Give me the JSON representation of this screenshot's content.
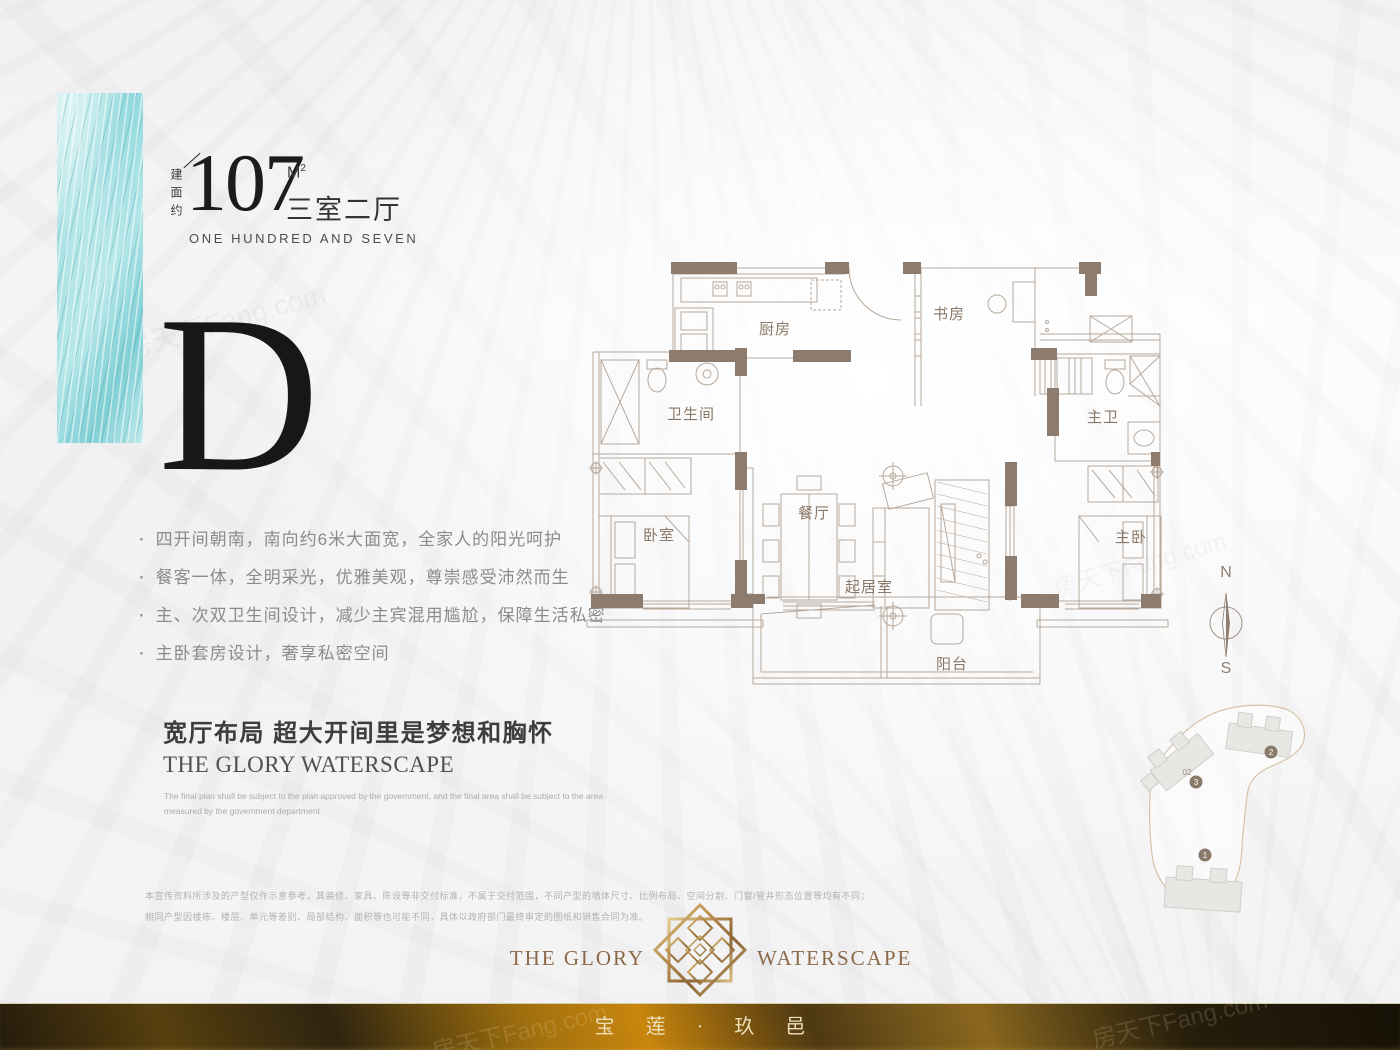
{
  "unit": {
    "area_prefix": "建面约",
    "area_value": "107",
    "area_unit": "M",
    "area_unit_sup": "2",
    "layout_type": "三室二厅",
    "area_words": "ONE HUNDRED AND SEVEN",
    "plan_letter": "D"
  },
  "features": [
    "四开间朝南，南向约6米大面宽，全家人的阳光呵护",
    "餐客一体，全明采光，优雅美观，尊崇感受沛然而生",
    "主、次双卫生间设计，减少主宾混用尴尬，保障生活私密",
    "主卧套房设计，奢享私密空间"
  ],
  "tagline": {
    "title": "宽厅布局 超大开间里是梦想和胸怀",
    "brand_en": "THE GLORY WATERSCAPE",
    "note_line1": "The final plan shall be subject to the plan approved by the government, and the final area shall be subject to the area",
    "note_line2": "measured by the government department"
  },
  "disclaimer": {
    "line1": "本宣传资料所涉及的产型仅作示意参考，其装修、家具、陈设等非交付标准，不属于交付范围，不同产型的墙体尺寸、比例布局、空间分割、门窗/管井形态位置等均有不同；",
    "line2": "相同产型因楼栋、楼层、单元等差别、局部结构、面积等也可能不同，具体以政府部门最终审定的图纸和销售合同为准。"
  },
  "floorplan": {
    "rooms": {
      "kitchen": "厨房",
      "study": "书房",
      "bathroom": "卫生间",
      "master_bathroom": "主卫",
      "bedroom": "卧室",
      "dining": "餐厅",
      "living": "起居室",
      "master_bedroom": "主卧",
      "balcony": "阳台"
    }
  },
  "compass": {
    "north": "N",
    "south": "S"
  },
  "siteplan": {
    "badge1": "1",
    "badge2": "2",
    "badge3": "3",
    "unit_label": "02"
  },
  "brand": {
    "name_left": "THE GLORY",
    "name_right": "WATERSCAPE",
    "name_cn": "宝 莲 · 玖 邑"
  },
  "watermark": {
    "text": "房天下Fang.com"
  },
  "colors": {
    "teal": "#8fd6da",
    "wall": "#8d7b6d",
    "line": "#b7a89b",
    "gold": "#b98f4f",
    "bar_text": "#eedfbb"
  }
}
